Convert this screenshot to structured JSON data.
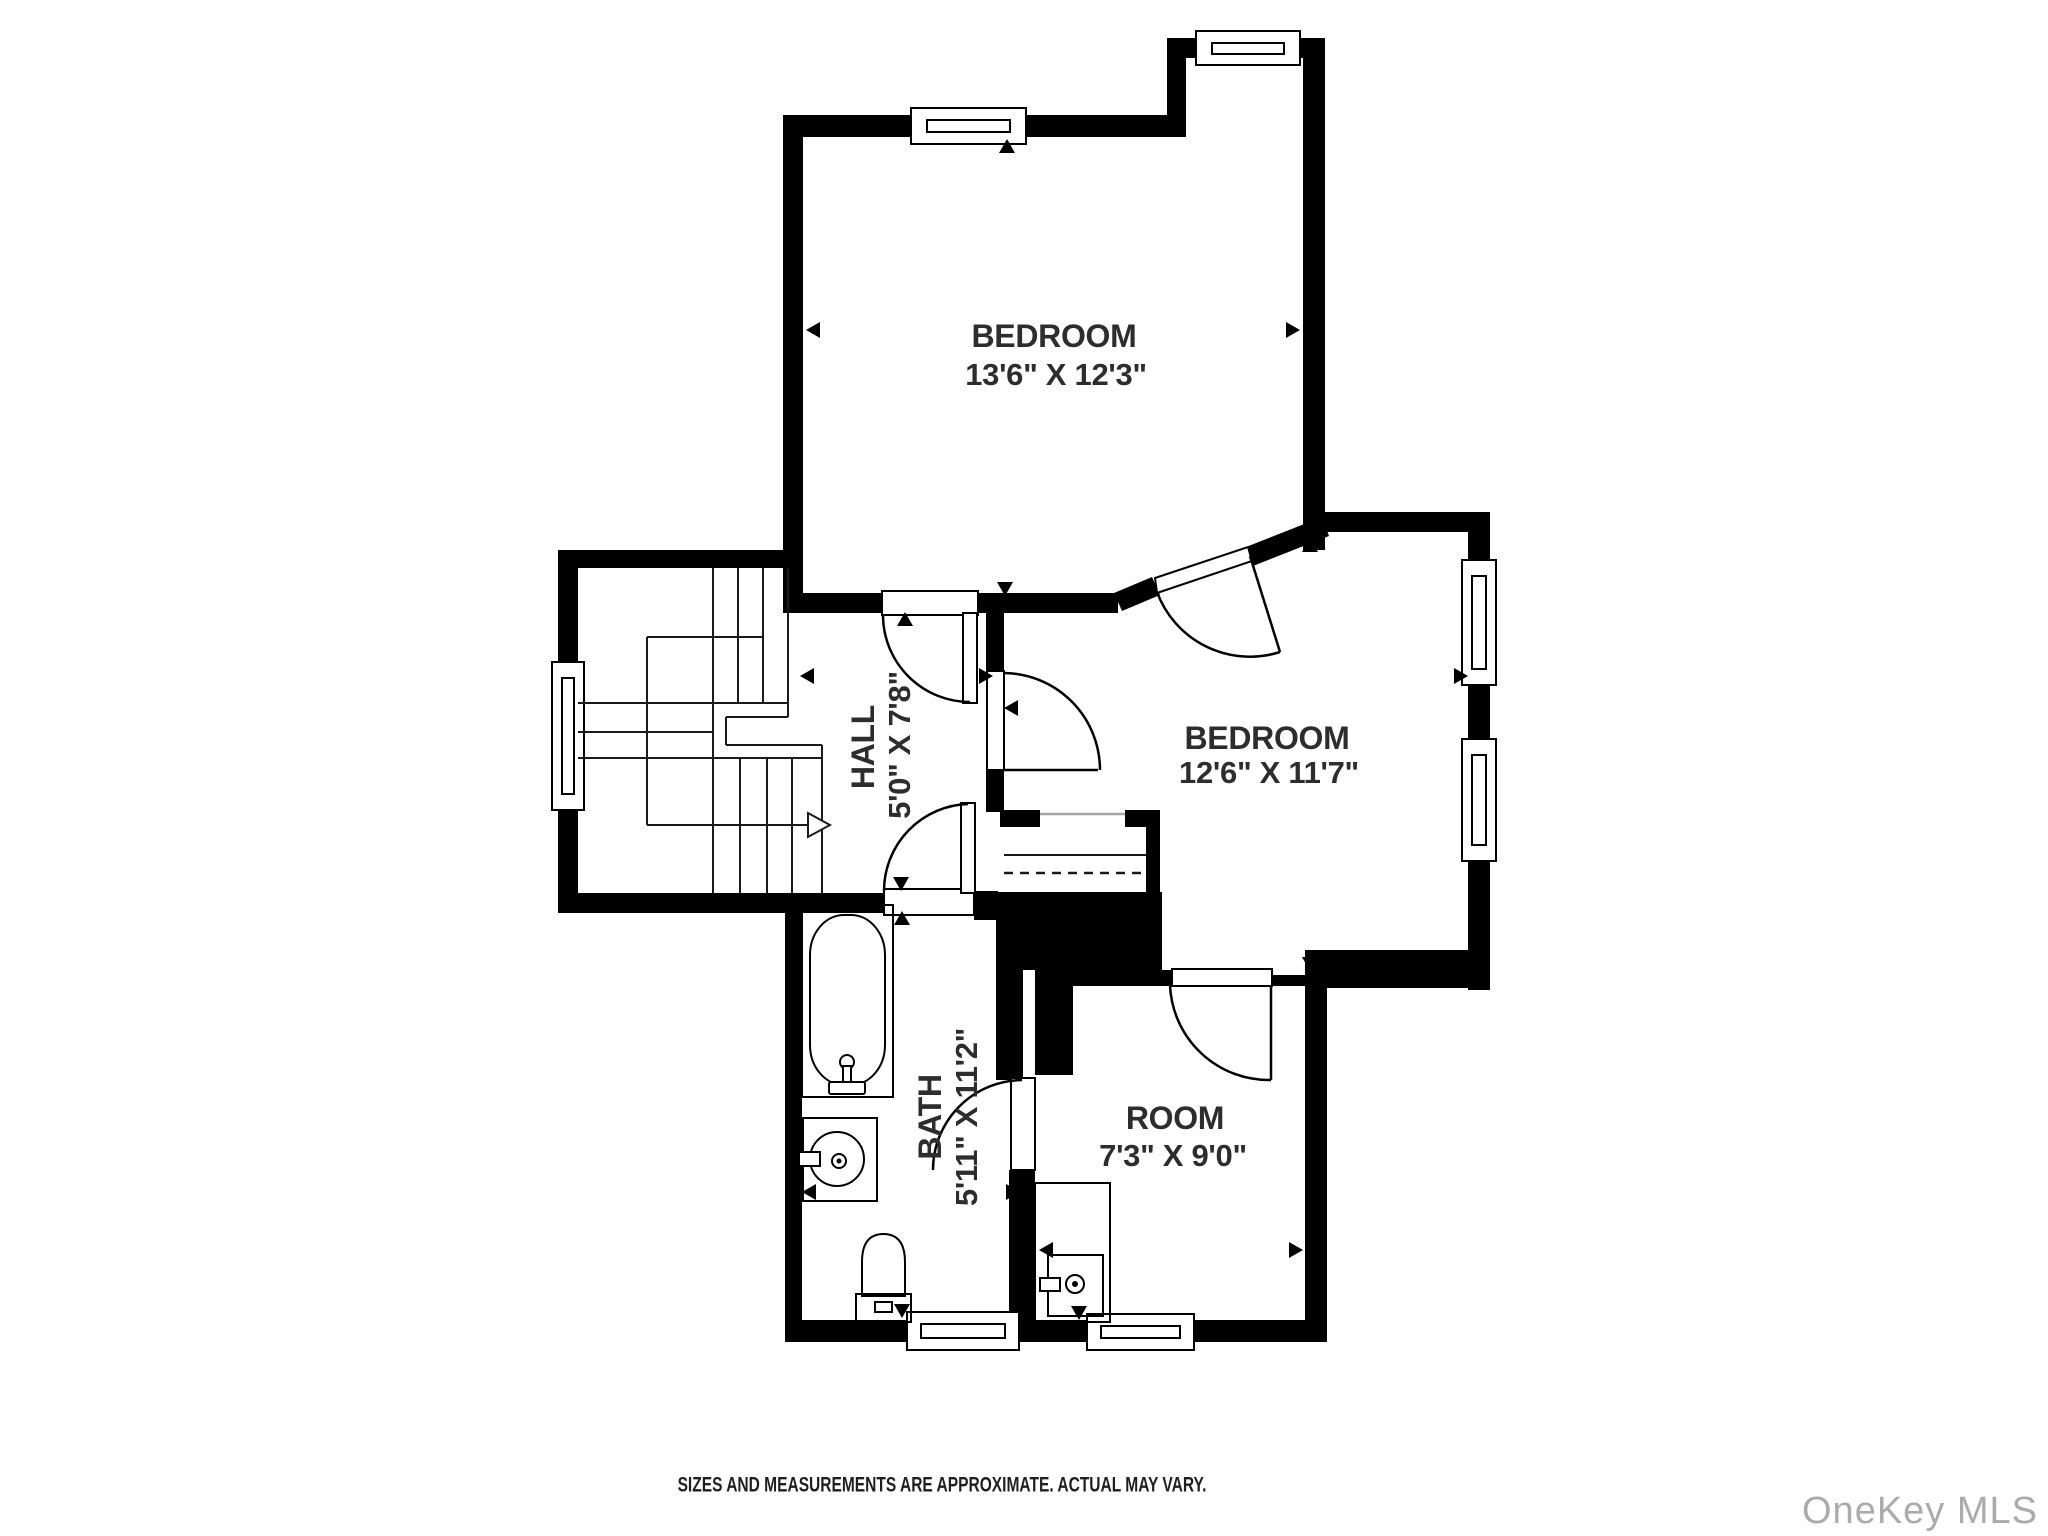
{
  "floorplan": {
    "rooms": [
      {
        "id": "bedroom-1",
        "name": "BEDROOM",
        "dims": "13'6\" X 12'3\""
      },
      {
        "id": "bedroom-2",
        "name": "BEDROOM",
        "dims": "12'6\" X 11'7\""
      },
      {
        "id": "hall",
        "name": "HALL",
        "dims": "5'0\" X 7'8\""
      },
      {
        "id": "bath",
        "name": "BATH",
        "dims": "5'11\" X 11'2\""
      },
      {
        "id": "room",
        "name": "ROOM",
        "dims": "7'3\" X 9'0\""
      }
    ],
    "colors": {
      "wall": "#000000",
      "label": "#2d2d2d",
      "watermark": "#ababab",
      "closet_line": "#a6a6a6"
    }
  },
  "footer": {
    "disclaimer": "SIZES AND MEASUREMENTS ARE APPROXIMATE. ACTUAL MAY VARY."
  },
  "watermark": {
    "text": "OneKey MLS"
  }
}
